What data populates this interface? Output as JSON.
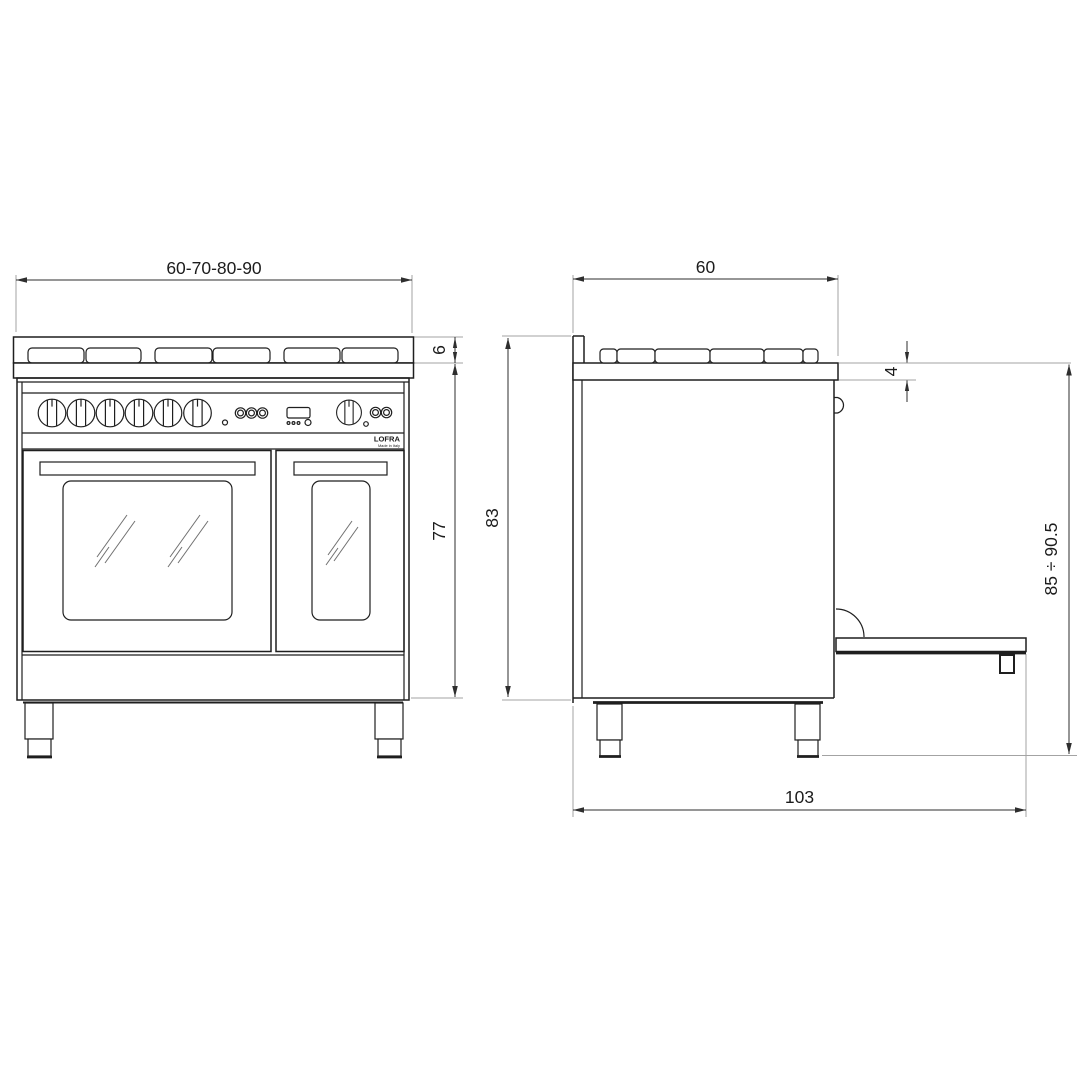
{
  "page": {
    "background": "#ffffff"
  },
  "drawing": {
    "type": "technical-dimension-drawing",
    "subject": "double-oven range cooker, front and side elevation",
    "views": {
      "front": {
        "dimensions": {
          "width": "60-70-80-90",
          "hob_edge_height": "6",
          "body_height": "77"
        },
        "brand": {
          "name": "LOFRA",
          "subtitle": "Made in Italy"
        }
      },
      "side": {
        "dimensions": {
          "depth": "60",
          "worktop_edge": "4",
          "height_to_hob": "83",
          "overall_height_range": "85 ÷ 90.5",
          "depth_with_door_open": "103"
        }
      }
    },
    "colors": {
      "line": "#1f1f1f",
      "dimension_line": "#2e2e2e",
      "extension_line": "#a3a3a3",
      "text": "#1c1c1c",
      "background": "#ffffff"
    }
  }
}
